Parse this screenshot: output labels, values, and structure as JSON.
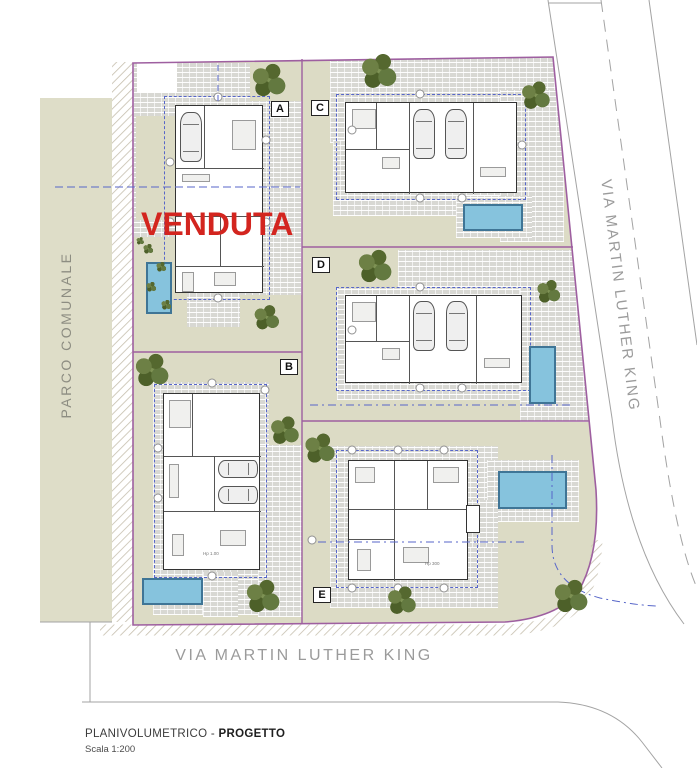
{
  "labels": {
    "park": "PARCO COMUNALE",
    "street_right": "VIA MARTIN LUTHER KING",
    "street_bottom": "VIA MARTIN LUTHER KING",
    "sold": "VENDUTA"
  },
  "caption": {
    "title_prefix": "PLANIVOLUMETRICO - ",
    "title_bold": "PROGETTO",
    "scale": "Scala 1:200"
  },
  "colors": {
    "lot_boundary": "#9e5fa0",
    "lawn": "#dcdbc5",
    "paving": "#d8d8d3",
    "pool": "#86c3dd",
    "pool_border": "#3f7596",
    "sold_red": "#d3251f",
    "street_text": "#9b9b9b",
    "park_strip": "#deddc8"
  },
  "lots": [
    {
      "id": "A",
      "sold": true
    },
    {
      "id": "B",
      "sold": false
    },
    {
      "id": "C",
      "sold": false
    },
    {
      "id": "D",
      "sold": false
    },
    {
      "id": "E",
      "sold": false
    }
  ],
  "plan": {
    "lot_labels": [
      {
        "id": "A",
        "x": 271,
        "y": 101
      },
      {
        "id": "B",
        "x": 280,
        "y": 359
      },
      {
        "id": "C",
        "x": 311,
        "y": 100
      },
      {
        "id": "D",
        "x": 312,
        "y": 257
      },
      {
        "id": "E",
        "x": 313,
        "y": 587
      }
    ],
    "pools": [
      {
        "lot": "A",
        "x": 146,
        "y": 262,
        "w": 26,
        "h": 52
      },
      {
        "lot": "B",
        "x": 142,
        "y": 578,
        "w": 61,
        "h": 27
      },
      {
        "lot": "C",
        "x": 463,
        "y": 204,
        "w": 60,
        "h": 27
      },
      {
        "lot": "D",
        "x": 529,
        "y": 346,
        "w": 27,
        "h": 58
      },
      {
        "lot": "E",
        "x": 498,
        "y": 471,
        "w": 69,
        "h": 38
      }
    ],
    "trees": [
      [
        268,
        81,
        40
      ],
      [
        266,
        318,
        30
      ],
      [
        378,
        72,
        42
      ],
      [
        535,
        96,
        34
      ],
      [
        374,
        267,
        40
      ],
      [
        548,
        292,
        28
      ],
      [
        151,
        371,
        40
      ],
      [
        284,
        431,
        34
      ],
      [
        262,
        597,
        40
      ],
      [
        319,
        449,
        36
      ],
      [
        401,
        601,
        34
      ],
      [
        570,
        597,
        40
      ]
    ],
    "bushes": [
      [
        148,
        249,
        12
      ],
      [
        161,
        267,
        12
      ],
      [
        151,
        287,
        12
      ],
      [
        166,
        305,
        12
      ],
      [
        140,
        241,
        9
      ]
    ],
    "house_notes": [
      {
        "text": "Hp 300",
        "x": 425,
        "y": 561
      },
      {
        "text": "Hp 1.00",
        "x": 203,
        "y": 551
      }
    ]
  }
}
